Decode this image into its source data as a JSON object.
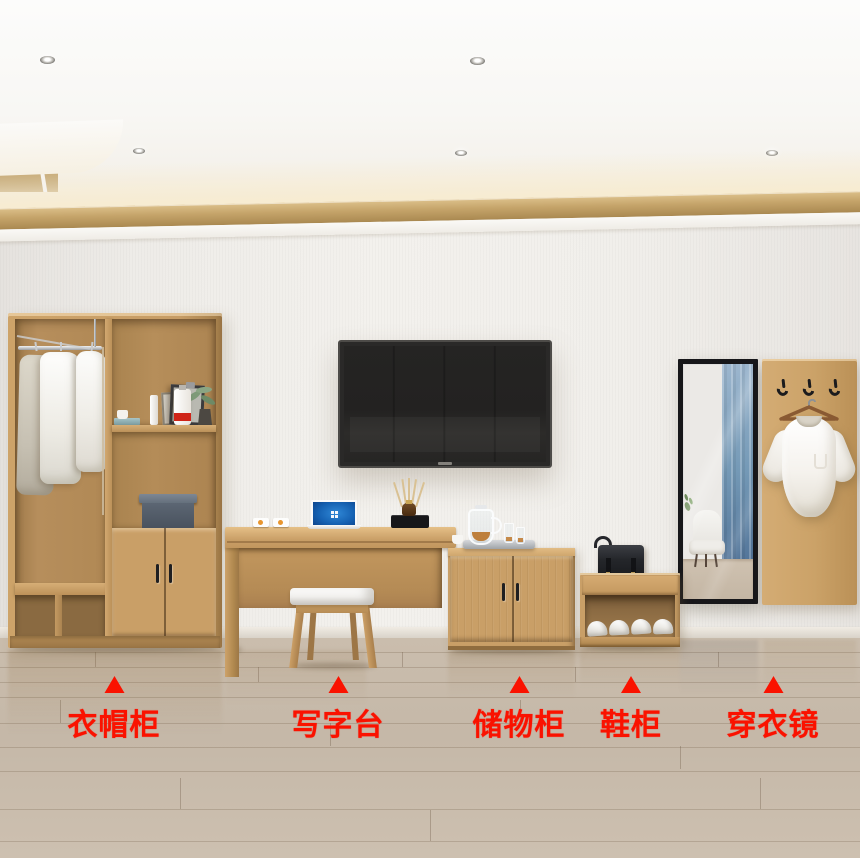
{
  "annotations": {
    "marker_icon": "triangle-up",
    "marker_color": "#fa1200",
    "items": [
      {
        "id": "wardrobe",
        "label": "衣帽柜"
      },
      {
        "id": "writing-desk",
        "label": "写字台"
      },
      {
        "id": "storage-cabinet",
        "label": "储物柜"
      },
      {
        "id": "shoe-cabinet",
        "label": "鞋柜"
      },
      {
        "id": "dressing-mirror",
        "label": "穿衣镜"
      }
    ]
  },
  "colors": {
    "accent_red": "#fa1200",
    "wood": "#c99f67",
    "wood_interior": "#b08857",
    "wall": "#f1efeb",
    "floor": "#c6b9a9",
    "gold_trim": "#c5a46a",
    "tv_screen": "#232221",
    "storage_box_blue": "#5c6673",
    "mirror_frame": "#17171a",
    "curtain_reflection": "#7499b6"
  }
}
